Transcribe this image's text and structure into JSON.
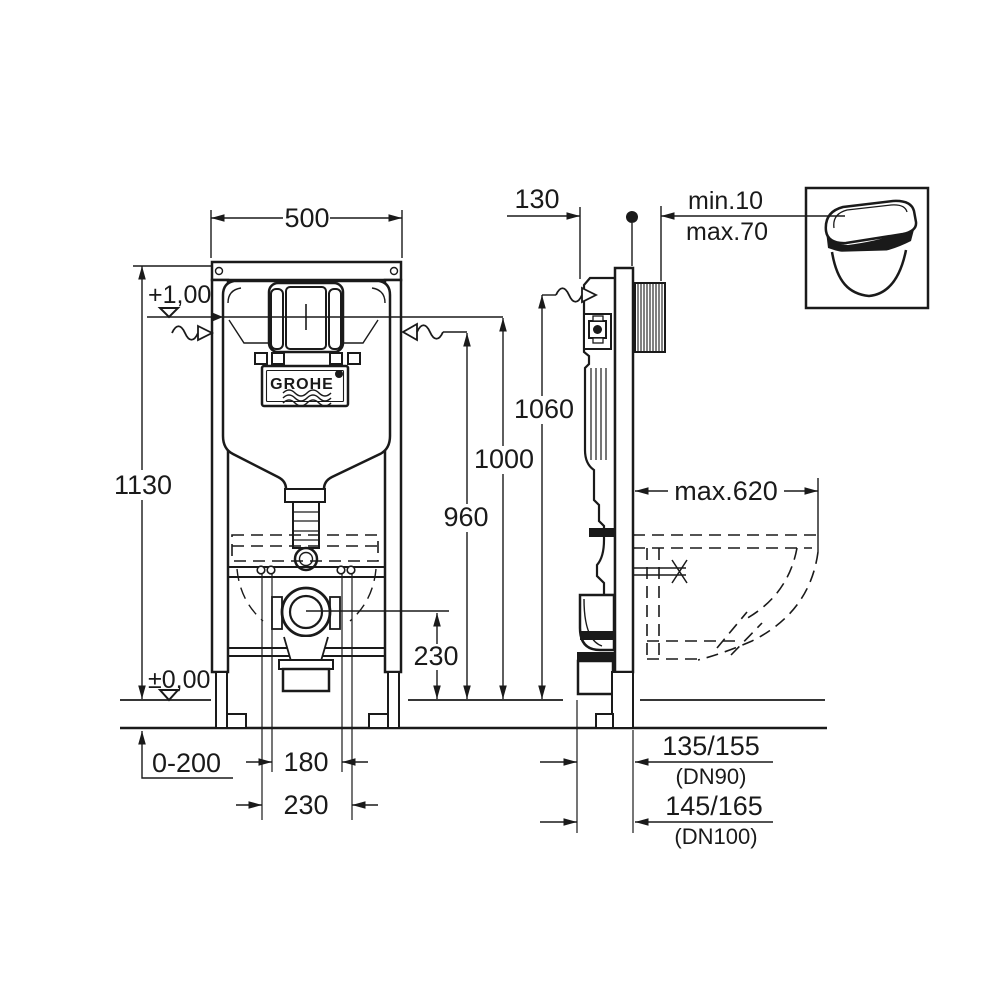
{
  "drawing": {
    "brand": "GROHE",
    "front": {
      "width": "500",
      "height": "1130",
      "level_top": "+1,00",
      "level_floor": "±0,00",
      "foot_range": "0-200",
      "spacing_inner": "180",
      "spacing_outer": "230",
      "outlet_center_height": "230"
    },
    "heights": {
      "supply": "960",
      "flush_plate": "1000",
      "frame_top": "1060"
    },
    "side": {
      "depth": "130",
      "wall_min": "min.10",
      "wall_max": "max.70",
      "bowl_projection": "max.620",
      "dn90_offset": "135/155",
      "dn90": "(DN90)",
      "dn100_offset": "145/165",
      "dn100": "(DN100)"
    }
  }
}
